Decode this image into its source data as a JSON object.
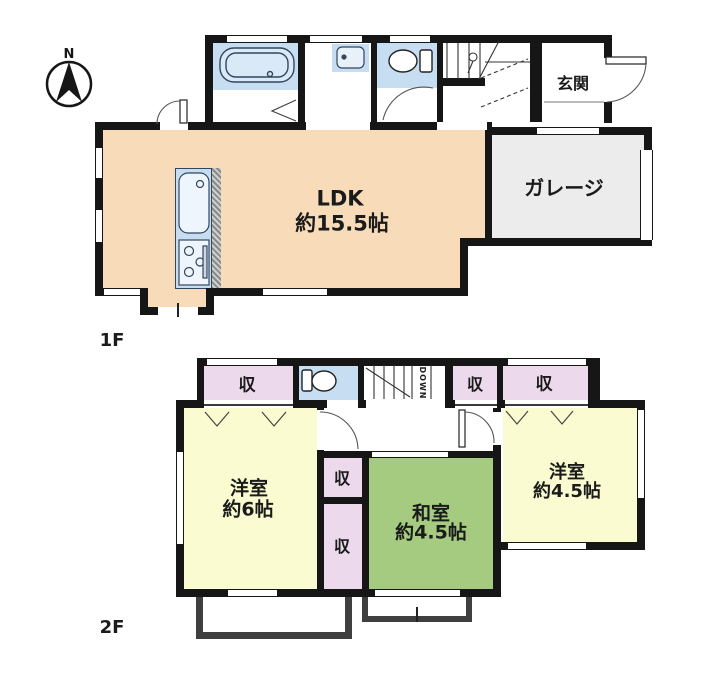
{
  "compass": {
    "label": "N"
  },
  "floor1": {
    "label": "1F",
    "rooms": {
      "ldk": {
        "name": "LDK",
        "size": "約15.5帖",
        "color": "#f8dcba"
      },
      "garage": {
        "name": "ガレージ",
        "color": "#ececec"
      },
      "entrance": {
        "name": "玄関"
      }
    },
    "fixtures": [
      "bathtub",
      "vanity-basin",
      "toilet",
      "kitchen-sink",
      "stove",
      "stairs"
    ]
  },
  "floor2": {
    "label": "2F",
    "rooms": {
      "western6": {
        "name": "洋室",
        "size": "約6帖",
        "color": "#fafbd0"
      },
      "japanese": {
        "name": "和室",
        "size": "約4.5帖",
        "color": "#a5cb80"
      },
      "western45": {
        "name": "洋室",
        "size": "約4.5帖",
        "color": "#fafbd0"
      }
    },
    "closets": {
      "c1": "収",
      "c2": "収",
      "c3": "収",
      "c4": "収",
      "c5": "収"
    },
    "stairs": {
      "label": "DOWN"
    },
    "fixtures": [
      "toilet",
      "balcony",
      "balcony"
    ]
  },
  "colors": {
    "wall": "#161616",
    "ldk_peach": "#f8dcba",
    "water_blue": "#c7def2",
    "garage_gray": "#ececec",
    "western_yellow": "#fafbd0",
    "japanese_green": "#a5cb80",
    "closet_pink": "#ecd9ec",
    "balcony_wall": "#3f3f3f"
  }
}
